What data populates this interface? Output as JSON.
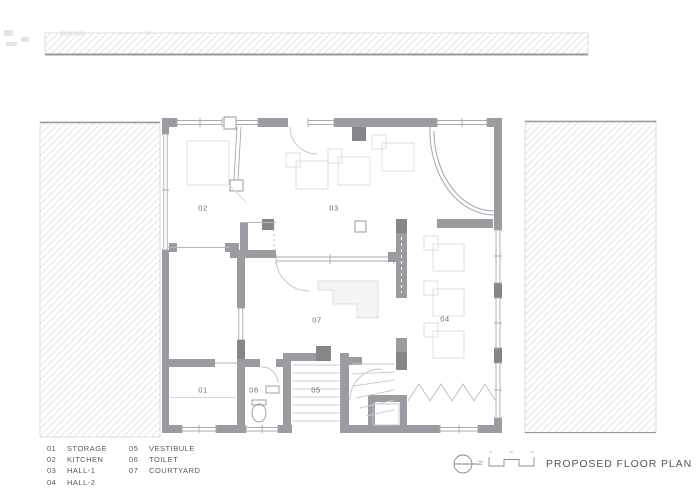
{
  "title_block": {
    "title": "PROPOSED FLOOR PLAN",
    "north_label": "N"
  },
  "rooms": [
    {
      "code": "01",
      "label": "STORAGE"
    },
    {
      "code": "02",
      "label": "KITCHEN"
    },
    {
      "code": "03",
      "label": "HALL-1"
    },
    {
      "code": "04",
      "label": "HALL-2"
    },
    {
      "code": "05",
      "label": "VESTIBULE"
    },
    {
      "code": "06",
      "label": "TOILET"
    },
    {
      "code": "07",
      "label": "COURTYARD"
    }
  ],
  "colors": {
    "wall": "#9b9ba1",
    "column": "#85858a",
    "hatch_line": "#e4e4e7",
    "thin_line": "#aaaaae",
    "furniture_line": "#dcdcdf",
    "text": "#58585c"
  }
}
